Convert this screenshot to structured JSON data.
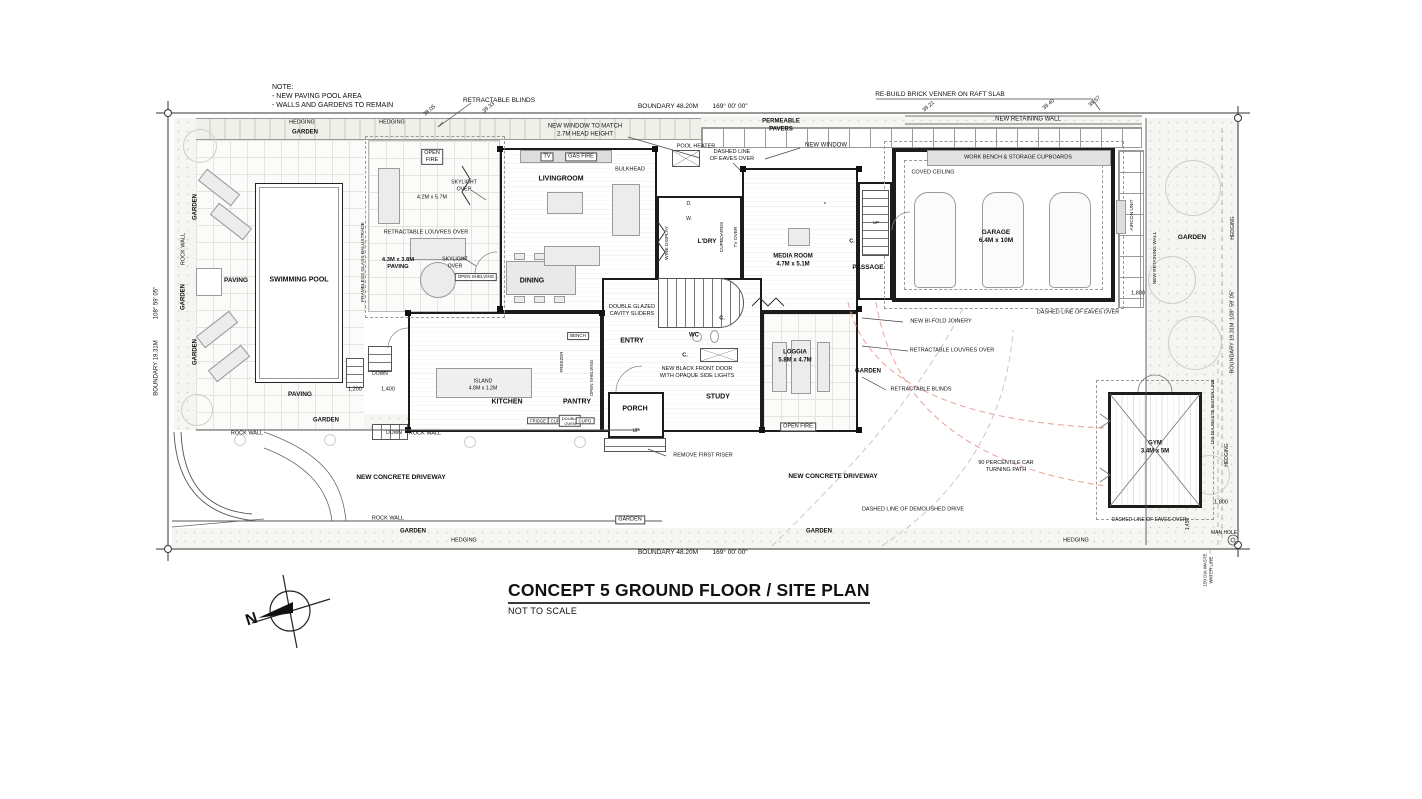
{
  "plan": {
    "title_block": {
      "title": "CONCEPT 5 GROUND FLOOR / SITE PLAN",
      "subtitle": "NOT TO SCALE"
    },
    "compass": {
      "north_label": "N"
    },
    "labels": [
      {
        "n": "note-text",
        "t": "NOTE:\n- NEW PAVING POOL AREA\n- WALLS AND GARDENS TO REMAIN",
        "x": 272,
        "y": 97,
        "s": 7,
        "a": "l"
      },
      {
        "n": "retractable-blinds-top-label",
        "t": "RETRACTABLE BLINDS",
        "x": 499,
        "y": 101,
        "s": 6.5
      },
      {
        "n": "new-window-match-label",
        "t": "NEW WINDOW TO MATCH\n2.7M HEAD HEIGHT",
        "x": 585,
        "y": 131,
        "s": 6
      },
      {
        "n": "boundary-top-length",
        "t": "BOUNDARY 48.20M",
        "x": 668,
        "y": 107,
        "s": 6.5
      },
      {
        "n": "boundary-top-angle",
        "t": "169° 00' 00\"",
        "x": 730,
        "y": 107,
        "s": 6.5
      },
      {
        "n": "permeable-pavers-label",
        "t": "PERMEABLE\nPAVERS",
        "x": 781,
        "y": 126,
        "s": 6,
        "b": true
      },
      {
        "n": "pool-heater-label",
        "t": "POOL HEATER",
        "x": 696,
        "y": 147,
        "s": 5.5
      },
      {
        "n": "eaves-top-label",
        "t": "DASHED LINE\nOF EAVES OVER",
        "x": 732,
        "y": 156,
        "s": 5.5
      },
      {
        "n": "new-window-top-label",
        "t": "NEW WINDOW",
        "x": 826,
        "y": 146,
        "s": 6
      },
      {
        "n": "rebuild-brick-label",
        "t": "RE-BUILD BRICK VENNER ON RAFT SLAB",
        "x": 940,
        "y": 95,
        "s": 6.5
      },
      {
        "n": "new-retaining-wall-top-label",
        "t": "NEW RETAINING WALL",
        "x": 1028,
        "y": 120,
        "s": 6
      },
      {
        "n": "spot-level-1",
        "t": "39.05",
        "x": 430,
        "y": 111,
        "s": 5.5,
        "r": -40
      },
      {
        "n": "spot-level-2",
        "t": "39.33",
        "x": 489,
        "y": 108,
        "s": 5.5,
        "r": -40
      },
      {
        "n": "spot-level-3",
        "t": "39.21",
        "x": 929,
        "y": 107,
        "s": 5.5,
        "r": -40
      },
      {
        "n": "spot-level-4",
        "t": "39.40",
        "x": 1049,
        "y": 105,
        "s": 5.5,
        "r": -40
      },
      {
        "n": "spot-level-5",
        "t": "39.57",
        "x": 1095,
        "y": 102,
        "s": 5.5,
        "r": -40
      },
      {
        "n": "hedging-top-1",
        "t": "HEDGING",
        "x": 302,
        "y": 123,
        "s": 5.5
      },
      {
        "n": "hedging-top-2",
        "t": "HEDGING",
        "x": 392,
        "y": 123,
        "s": 5.5
      },
      {
        "n": "garden-top-label",
        "t": "GARDEN",
        "x": 305,
        "y": 133,
        "s": 6,
        "b": true
      },
      {
        "n": "garden-left-1",
        "t": "GARDEN",
        "x": 196,
        "y": 207,
        "s": 6,
        "b": true,
        "r": -90
      },
      {
        "n": "rock-wall-left",
        "t": "ROCK WALL",
        "x": 184,
        "y": 249,
        "s": 5.5,
        "r": -90
      },
      {
        "n": "garden-left-2",
        "t": "GARDEN",
        "x": 184,
        "y": 297,
        "s": 6,
        "b": true,
        "r": -90
      },
      {
        "n": "garden-left-3",
        "t": "GARDEN",
        "x": 196,
        "y": 352,
        "s": 6,
        "b": true,
        "r": -90
      },
      {
        "n": "boundary-left-length",
        "t": "BOUNDARY 19.31M",
        "x": 157,
        "y": 368,
        "s": 6,
        "r": -90
      },
      {
        "n": "boundary-left-angle",
        "t": "108° 59' 05\"",
        "x": 157,
        "y": 303,
        "s": 6,
        "r": -90
      },
      {
        "n": "paving-label-1",
        "t": "PAVING",
        "x": 236,
        "y": 281,
        "s": 6.5,
        "b": true
      },
      {
        "n": "swimming-pool-label",
        "t": "SWIMMING POOL",
        "x": 299,
        "y": 281,
        "s": 7,
        "b": true
      },
      {
        "n": "frameless-balustrade-label",
        "t": "FRAMELESS GLASS BALUSTRADE",
        "x": 364,
        "y": 262,
        "s": 4.8,
        "r": -90
      },
      {
        "n": "paving-label-2",
        "t": "PAVING",
        "x": 300,
        "y": 395,
        "s": 6.5,
        "b": true
      },
      {
        "n": "paving-table-label",
        "t": "4.3M x 3.8M\nPAVING",
        "x": 398,
        "y": 264,
        "s": 5.8,
        "b": true
      },
      {
        "n": "dim-1200",
        "t": "1,200",
        "x": 355,
        "y": 390,
        "s": 5.5
      },
      {
        "n": "dim-1400",
        "t": "1,400",
        "x": 388,
        "y": 390,
        "s": 5.5
      },
      {
        "n": "down-label-1",
        "t": "DOWN",
        "x": 380,
        "y": 374,
        "s": 5
      },
      {
        "n": "down-label-2",
        "t": "DOWN",
        "x": 394,
        "y": 433,
        "s": 5
      },
      {
        "n": "garden-bottomleft",
        "t": "GARDEN",
        "x": 326,
        "y": 421,
        "s": 6,
        "b": true
      },
      {
        "n": "rock-wall-bottom-1",
        "t": "ROCK WALL",
        "x": 247,
        "y": 434,
        "s": 5.5
      },
      {
        "n": "rock-wall-bottom-2",
        "t": "ROCK WALL",
        "x": 425,
        "y": 434,
        "s": 5.5
      },
      {
        "n": "rock-wall-bottom-3",
        "t": "ROCK WALL",
        "x": 388,
        "y": 519,
        "s": 5.5
      },
      {
        "n": "garden-bottom-1",
        "t": "GARDEN",
        "x": 413,
        "y": 532,
        "s": 6,
        "b": true
      },
      {
        "n": "hedging-bottom-1",
        "t": "HEDGING",
        "x": 464,
        "y": 541,
        "s": 5.5
      },
      {
        "n": "boundary-bottom-length",
        "t": "BOUNDARY 48.20M",
        "x": 668,
        "y": 553,
        "s": 6.5
      },
      {
        "n": "boundary-bottom-angle",
        "t": "169° 00' 00\"",
        "x": 730,
        "y": 553,
        "s": 6.5
      },
      {
        "n": "garden-box-label",
        "t": "GARDEN",
        "x": 630,
        "y": 520,
        "s": 5.5,
        "bx": true
      },
      {
        "n": "garden-bottom-2",
        "t": "GARDEN",
        "x": 819,
        "y": 532,
        "s": 6,
        "b": true
      },
      {
        "n": "hedging-bottom-2",
        "t": "HEDGING",
        "x": 1076,
        "y": 541,
        "s": 5.5
      },
      {
        "n": "open-fire-terrace",
        "t": "OPEN\nFIRE",
        "x": 432,
        "y": 157,
        "s": 5.5,
        "bx": true
      },
      {
        "n": "dim-terrace",
        "t": "4.2M x 5.7M",
        "x": 432,
        "y": 198,
        "s": 5.5
      },
      {
        "n": "louvres-terrace-label",
        "t": "RETRACTABLE LOUVRES OVER",
        "x": 426,
        "y": 233,
        "s": 5.5
      },
      {
        "n": "skylight-label-1",
        "t": "SKYLIGHT\nOVER",
        "x": 464,
        "y": 186,
        "s": 5.2
      },
      {
        "n": "skylight-label-2",
        "t": "SKYLIGHT\nOVER",
        "x": 455,
        "y": 263,
        "s": 5.2
      },
      {
        "n": "tv-label",
        "t": "TV",
        "x": 547,
        "y": 157,
        "s": 5.5,
        "bx": true
      },
      {
        "n": "gas-fire-label",
        "t": "GAS FIRE",
        "x": 581,
        "y": 157,
        "s": 5.5,
        "bx": true
      },
      {
        "n": "livingroom-label",
        "t": "LIVINGROOM",
        "x": 561,
        "y": 180,
        "s": 7,
        "b": true
      },
      {
        "n": "bulkhead-label",
        "t": "BULKHEAD",
        "x": 630,
        "y": 170,
        "s": 5.5
      },
      {
        "n": "dining-label",
        "t": "DINING",
        "x": 532,
        "y": 282,
        "s": 7,
        "b": true
      },
      {
        "n": "double-glazed-label",
        "t": "DOUBLE GLAZED\nCAVITY SLIDERS",
        "x": 632,
        "y": 311,
        "s": 5.5
      },
      {
        "n": "open-shelving-1",
        "t": "OPEN SHELVING",
        "x": 476,
        "y": 277,
        "s": 4.5,
        "bx": true
      },
      {
        "n": "bench-label",
        "t": "BENCH",
        "x": 578,
        "y": 336,
        "s": 4.5,
        "bx": true
      },
      {
        "n": "island-label",
        "t": "ISLAND\n4.8M x 1.2M",
        "x": 483,
        "y": 385,
        "s": 5.2
      },
      {
        "n": "kitchen-label",
        "t": "KITCHEN",
        "x": 507,
        "y": 403,
        "s": 7,
        "b": true
      },
      {
        "n": "pantry-label",
        "t": "PANTRY",
        "x": 577,
        "y": 403,
        "s": 7,
        "b": true
      },
      {
        "n": "open-shelving-2",
        "t": "OPEN SHELVING",
        "x": 592,
        "y": 378,
        "s": 4.5,
        "r": -90
      },
      {
        "n": "freezer-label",
        "t": "FREEZER",
        "x": 562,
        "y": 362,
        "s": 4.5,
        "r": -90
      },
      {
        "n": "fridge-label",
        "t": "FRIDGE",
        "x": 538,
        "y": 421,
        "s": 4.2,
        "bx": true
      },
      {
        "n": "cupd-label-1",
        "t": "CUP'D",
        "x": 557,
        "y": 421,
        "s": 4.2,
        "bx": true
      },
      {
        "n": "double-oven-label",
        "t": "DOUBLE\nOVEN",
        "x": 570,
        "y": 421,
        "s": 4,
        "bx": true
      },
      {
        "n": "cupd-label-2",
        "t": "CUP'D",
        "x": 585,
        "y": 421,
        "s": 4.2,
        "bx": true
      },
      {
        "n": "entry-label",
        "t": "ENTRY",
        "x": 632,
        "y": 342,
        "s": 7,
        "b": true
      },
      {
        "n": "porch-label",
        "t": "PORCH",
        "x": 635,
        "y": 410,
        "s": 7,
        "b": true
      },
      {
        "n": "up-porch-label",
        "t": "UP",
        "x": 636,
        "y": 431,
        "s": 5
      },
      {
        "n": "study-label",
        "t": "STUDY",
        "x": 718,
        "y": 398,
        "s": 7,
        "b": true
      },
      {
        "n": "black-door-label",
        "t": "NEW BLACK FRONT DOOR\nWITH OPAQUE SIDE LIGHTS",
        "x": 697,
        "y": 373,
        "s": 5.5
      },
      {
        "n": "wc-label",
        "t": "WC",
        "x": 694,
        "y": 336,
        "s": 6,
        "b": true
      },
      {
        "n": "closet-label-1",
        "t": "C.",
        "x": 685,
        "y": 356,
        "s": 5.5,
        "b": true
      },
      {
        "n": "closet-label-2",
        "t": "C.",
        "x": 722,
        "y": 319,
        "s": 5.5,
        "b": true
      },
      {
        "n": "remove-riser-label",
        "t": "REMOVE FIRST RISER",
        "x": 703,
        "y": 456,
        "s": 5.5
      },
      {
        "n": "wine-display-label",
        "t": "WINE DISPLAY",
        "x": 668,
        "y": 243,
        "s": 4.8,
        "r": -90
      },
      {
        "n": "dryer-label",
        "t": "D.",
        "x": 689,
        "y": 204,
        "s": 5
      },
      {
        "n": "washer-label",
        "t": "W.",
        "x": 689,
        "y": 219,
        "s": 5
      },
      {
        "n": "ldry-label",
        "t": "L'DRY",
        "x": 707,
        "y": 242,
        "s": 6.5,
        "b": true
      },
      {
        "n": "cupboards-label",
        "t": "CUPBOARDS",
        "x": 723,
        "y": 237,
        "s": 4.8,
        "r": -90
      },
      {
        "n": "tv-over-label",
        "t": "TV OVER",
        "x": 737,
        "y": 237,
        "s": 4.8,
        "r": -90
      },
      {
        "n": "media-room-label",
        "t": "MEDIA ROOM\n4.7M x 5.1M",
        "x": 793,
        "y": 261,
        "s": 6,
        "b": true
      },
      {
        "n": "passage-label",
        "t": "PASSAGE",
        "x": 868,
        "y": 268,
        "s": 6.5,
        "b": true
      },
      {
        "n": "up-stair-label",
        "t": "UP",
        "x": 876,
        "y": 224,
        "s": 4.8
      },
      {
        "n": "closet-label-3",
        "t": "C.",
        "x": 852,
        "y": 242,
        "s": 5.5,
        "b": true
      },
      {
        "n": "loggia-label",
        "t": "LOGGIA\n5.8M x 4.7M",
        "x": 795,
        "y": 357,
        "s": 6,
        "b": true
      },
      {
        "n": "garden-strip-label",
        "t": "GARDEN",
        "x": 868,
        "y": 372,
        "s": 6,
        "b": true
      },
      {
        "n": "open-fire-loggia",
        "t": "OPEN FIRE",
        "x": 798,
        "y": 427,
        "s": 5.5,
        "bx": true
      },
      {
        "n": "bifold-label",
        "t": "NEW BI-FOLD JOINERY",
        "x": 941,
        "y": 322,
        "s": 5.5
      },
      {
        "n": "louvres-right-label",
        "t": "RETRACTABLE LOUVRES OVER",
        "x": 952,
        "y": 351,
        "s": 5.5
      },
      {
        "n": "blinds-right-label",
        "t": "RETRACTABLE BLINDS",
        "x": 921,
        "y": 390,
        "s": 5.5
      },
      {
        "n": "work-bench-label",
        "t": "WORK BENCH & STORAGE CUPBOARDS",
        "x": 1018,
        "y": 158,
        "s": 5.5
      },
      {
        "n": "coved-ceiling-label",
        "t": "COVED CEILING",
        "x": 933,
        "y": 173,
        "s": 5.5
      },
      {
        "n": "garage-label",
        "t": "GARAGE\n6.4M x 10M",
        "x": 996,
        "y": 237,
        "s": 6.5,
        "b": true
      },
      {
        "n": "aircon-label",
        "t": "AIRCON UNIT",
        "x": 1133,
        "y": 215,
        "s": 4.8,
        "r": -90
      },
      {
        "n": "retaining-right-label",
        "t": "NEW RETAINING WALL",
        "x": 1156,
        "y": 258,
        "s": 4.8,
        "r": -90
      },
      {
        "n": "dim-1800-garage",
        "t": "1,800",
        "x": 1138,
        "y": 294,
        "s": 5.5
      },
      {
        "n": "eaves-garage-label",
        "t": "DASHED LINE OF EAVES OVER",
        "x": 1078,
        "y": 313,
        "s": 5.5
      },
      {
        "n": "garden-right-label",
        "t": "GARDEN",
        "x": 1192,
        "y": 238,
        "s": 6.5,
        "b": true
      },
      {
        "n": "hedging-right-1",
        "t": "HEDGING",
        "x": 1233,
        "y": 228,
        "s": 5,
        "r": -90
      },
      {
        "n": "boundary-right-length",
        "t": "BOUNDARY 19.31M",
        "x": 1233,
        "y": 348,
        "s": 5.5,
        "r": -90
      },
      {
        "n": "boundary-right-angle",
        "t": "108° 59' 05\"",
        "x": 1233,
        "y": 305,
        "s": 5.5,
        "r": -90
      },
      {
        "n": "waste-line-label",
        "t": "150 DIA WASTE WATER LINE",
        "x": 1214,
        "y": 412,
        "s": 4.8,
        "r": -90
      },
      {
        "n": "hedging-right-2",
        "t": "HEDGING",
        "x": 1227,
        "y": 455,
        "s": 5,
        "r": -90
      },
      {
        "n": "gym-label",
        "t": "GYM\n3.4M x 5M",
        "x": 1155,
        "y": 448,
        "s": 6,
        "b": true
      },
      {
        "n": "eaves-gym-label",
        "t": "DASHED LINE OF EAVES OVER",
        "x": 1149,
        "y": 520,
        "s": 5
      },
      {
        "n": "dim-1800-gym",
        "t": "1,800",
        "x": 1221,
        "y": 503,
        "s": 5.5
      },
      {
        "n": "dim-1450",
        "t": "1,450",
        "x": 1188,
        "y": 524,
        "s": 5,
        "r": -90
      },
      {
        "n": "man-hole-label",
        "t": "MAN HOLE",
        "x": 1224,
        "y": 533,
        "s": 5
      },
      {
        "n": "waste-line-label-2",
        "t": "150 DIA WASTE\nWATER LINE",
        "x": 1208,
        "y": 570,
        "s": 4.5,
        "r": -90
      },
      {
        "n": "driveway-label-1",
        "t": "NEW CONCRETE DRIVEWAY",
        "x": 401,
        "y": 478,
        "s": 6.5,
        "b": true
      },
      {
        "n": "driveway-label-2",
        "t": "NEW CONCRETE DRIVEWAY",
        "x": 833,
        "y": 477,
        "s": 6.5,
        "b": true
      },
      {
        "n": "turning-path-label",
        "t": "90 PERCENTILE CAR\nTURNING PATH",
        "x": 1006,
        "y": 467,
        "s": 5.5
      },
      {
        "n": "demolished-drive-label",
        "t": "DASHED LINE OF DEMOLISHED DRIVE",
        "x": 913,
        "y": 510,
        "s": 5.5
      }
    ]
  }
}
